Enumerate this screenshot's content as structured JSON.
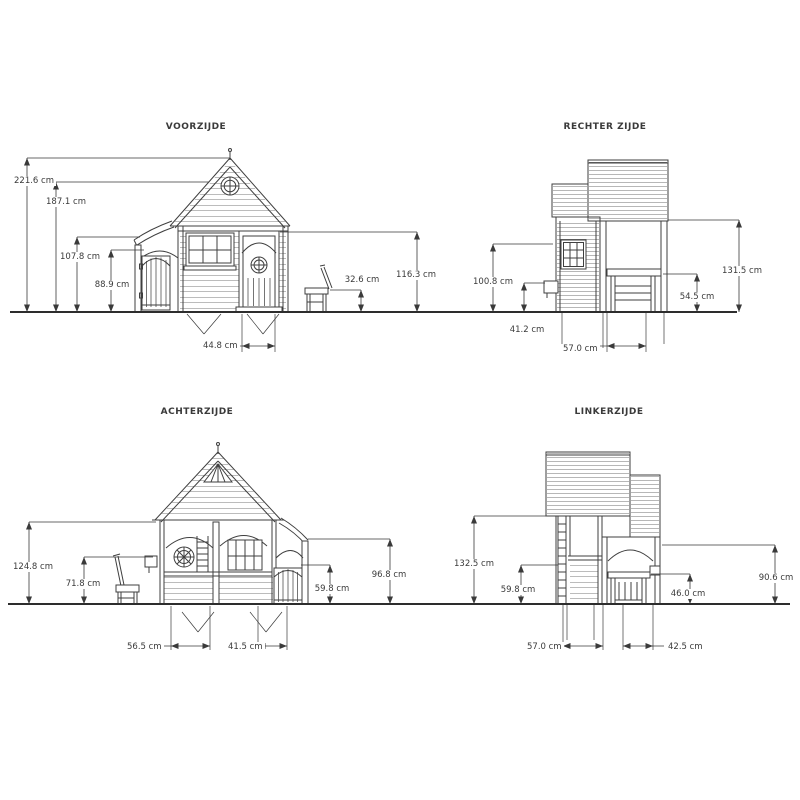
{
  "drawing": {
    "unit": "cm",
    "colors": {
      "line": "#3f3f3f",
      "text": "#3a3a3a",
      "background": "#ffffff"
    },
    "views": {
      "front": {
        "title": "VOORZIJDE",
        "dims": {
          "total_height": "221.6 cm",
          "eaves_height": "187.1 cm",
          "door_height": "116.3 cm",
          "porch_height": "107.8 cm",
          "gate_height": "88.9 cm",
          "bench_height": "32.6 cm",
          "door_width": "44.8 cm"
        }
      },
      "right": {
        "title": "RECHTER ZIJDE",
        "dims": {
          "roof_height": "131.5 cm",
          "wall_height": "100.8 cm",
          "table_height": "54.5 cm",
          "window_height": "41.2 cm",
          "base_width": "57.0 cm"
        }
      },
      "back": {
        "title": "ACHTERZIJDE",
        "dims": {
          "eaves_height": "124.8 cm",
          "porch_height": "96.8 cm",
          "chair_height": "71.8 cm",
          "fence_height": "59.8 cm",
          "left_width": "56.5 cm",
          "door_width": "41.5 cm"
        }
      },
      "left": {
        "title": "LINKERZIJDE",
        "dims": {
          "roof_height": "132.5 cm",
          "porch_height": "90.6 cm",
          "wall_height": "59.8 cm",
          "rail_height": "46.0 cm",
          "main_width": "57.0 cm",
          "porch_width": "42.5 cm"
        }
      }
    }
  }
}
